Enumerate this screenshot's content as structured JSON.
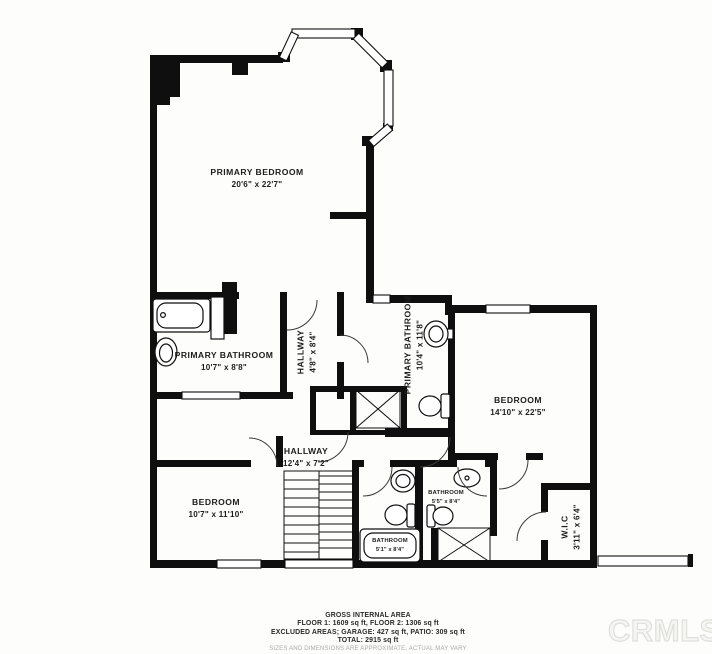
{
  "floor_plan": {
    "rooms": [
      {
        "id": "primary-bedroom",
        "name": "PRIMARY BEDROOM",
        "dimensions": "20'6\" x 22'7\""
      },
      {
        "id": "primary-bathroom",
        "name": "PRIMARY BATHROOM",
        "dimensions": "10'7\" x 8'8\""
      },
      {
        "id": "hallway-upper",
        "name": "HALLWAY",
        "dimensions": "4'8\" x 8'4\""
      },
      {
        "id": "primary-bathroom-2",
        "name": "PRIMARY BATHROOM",
        "dimensions": "10'4\" x 11'8\""
      },
      {
        "id": "bedroom-right",
        "name": "BEDROOM",
        "dimensions": "14'10\" x 22'5\""
      },
      {
        "id": "hallway-main",
        "name": "HALLWAY",
        "dimensions": "12'4\" x 7'2\""
      },
      {
        "id": "bedroom-left",
        "name": "BEDROOM",
        "dimensions": "10'7\" x 11'10\""
      },
      {
        "id": "bathroom-small",
        "name": "BATHROOM",
        "dimensions": "5'5\" x 8'4\""
      },
      {
        "id": "bathroom-lower",
        "name": "BATHROOM",
        "dimensions": "5'1\" x 8'4\""
      },
      {
        "id": "walk-in-closet",
        "name": "W.I.C",
        "dimensions": "3'11\" x 6'4\""
      }
    ],
    "footer": {
      "title": "GROSS INTERNAL AREA",
      "line1": "FLOOR 1: 1609 sq ft, FLOOR 2: 1306 sq ft",
      "line2": "EXCLUDED AREAS; GARAGE: 427 sq ft, PATIO: 309 sq ft",
      "line3": "TOTAL: 2915 sq ft",
      "disclaimer": "SIZES AND DIMENSIONS ARE APPROXIMATE, ACTUAL MAY VARY"
    },
    "watermark": "CRMLS",
    "colors": {
      "wall": "#0f0f0f",
      "background": "#ffffff",
      "label": "#1d1d1d",
      "disclaimer": "#a9a9a6",
      "watermark_stroke": "#dfdfdb"
    }
  }
}
